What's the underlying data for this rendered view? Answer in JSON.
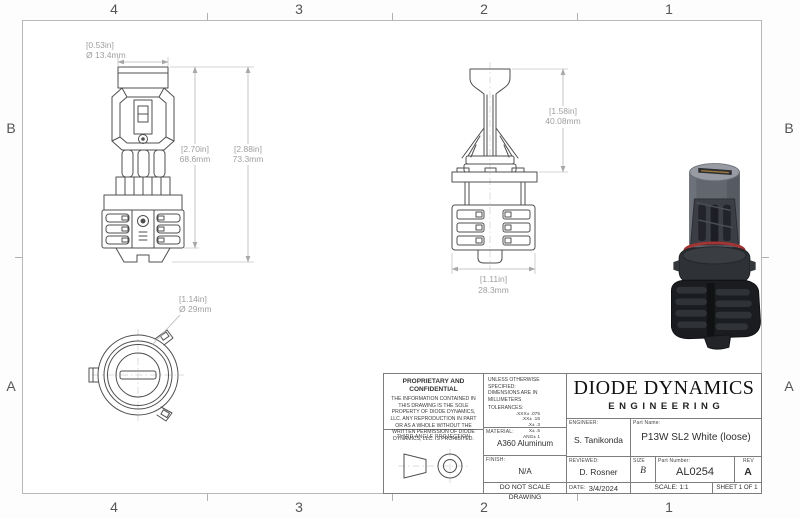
{
  "sheet": {
    "zones_top": [
      "4",
      "3",
      "2",
      "1"
    ],
    "zones_bottom": [
      "4",
      "3",
      "2",
      "1"
    ],
    "zones_left": [
      "B",
      "A"
    ],
    "zones_right": [
      "B",
      "A"
    ]
  },
  "dimensions": {
    "front_diameter": {
      "in": "[0.53in]",
      "mm": "Ø 13.4mm"
    },
    "front_body_height": {
      "in": "[2.70in]",
      "mm": "68.6mm"
    },
    "front_total_height": {
      "in": "[2.88in]",
      "mm": "73.3mm"
    },
    "side_blade_height": {
      "in": "[1.58in]",
      "mm": "40.08mm"
    },
    "side_base_width": {
      "in": "[1.11in]",
      "mm": "28.3mm"
    },
    "bottom_diameter": {
      "in": "[1.14in]",
      "mm": "Ø 29mm"
    }
  },
  "title_block": {
    "proprietary_title": "PROPRIETARY AND CONFIDENTIAL",
    "proprietary_body": "THE INFORMATION CONTAINED IN THIS DRAWING IS THE SOLE PROPERTY OF DIODE DYNAMICS, LLC.  ANY REPRODUCTION IN PART OR AS A WHOLE WITHOUT THE WRITTEN PERMISSION OF DIODE DYNAMICS, LLC. IS PROHIBITED.",
    "third_angle_label": "THIRD ANGLE PROJECTION",
    "unless_line1": "UNLESS OTHERWISE SPECIFIED:",
    "unless_line2": "DIMENSIONS ARE IN MILLIMETERS",
    "tolerances_label": "TOLERANCES:",
    "tolerances": [
      ".XXX± .075",
      ".XX± .15",
      ".X± .3",
      "X± .5",
      "ANG± 1"
    ],
    "material_label": "MATERIAL:",
    "material_value": "A360 Aluminum",
    "finish_label": "FINISH:",
    "finish_value": "N/A",
    "do_not_scale": "DO NOT SCALE DRAWING",
    "logo_line1": "DIODE DYNAMICS",
    "logo_line2": "ENGINEERING",
    "engineer_label": "ENGINEER:",
    "engineer_value": "S. Tanikonda",
    "part_name_label": "Part Name:",
    "part_name_value": "P13W SL2 White (loose)",
    "reviewed_label": "REVIEWED:",
    "reviewed_value": "D. Rosner",
    "size_label": "SIZE",
    "size_value": "B",
    "part_number_label": "Part Number:",
    "part_number_value": "AL0254",
    "rev_label": "REV",
    "rev_value": "A",
    "date_label": "DATE:",
    "date_value": "3/4/2024",
    "scale_text": "SCALE: 1:1",
    "sheet_text": "SHEET 1 OF 1"
  },
  "colors": {
    "drawing_line": "#4f4f4f",
    "dimension_text": "#9f9f9f",
    "frame_line": "#b8b8b8",
    "oring_red": "#a23434"
  }
}
